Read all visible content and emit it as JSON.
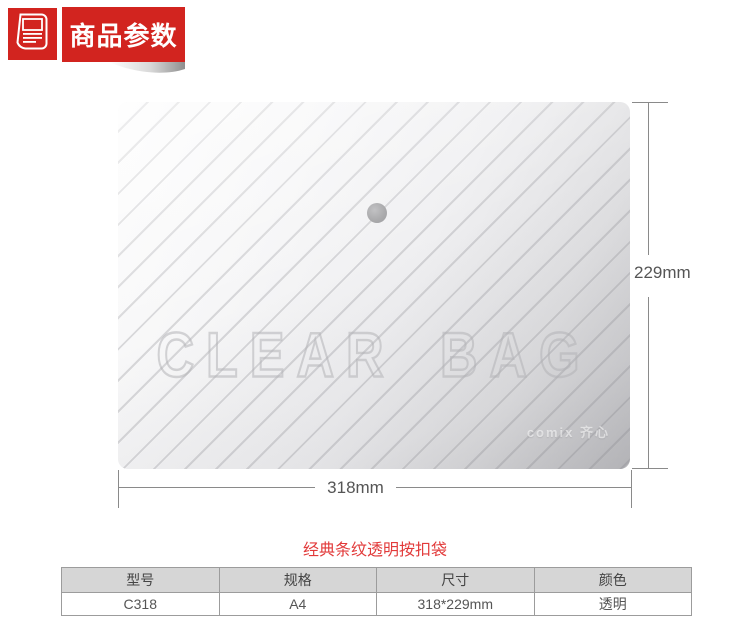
{
  "header": {
    "badge_label": "商品参数",
    "icon": "document-icon"
  },
  "product_image": {
    "watermark": "CLEAR BAG",
    "brand_mark": "comix 齐心",
    "snap_button": "snap-fastener",
    "height_dimension": "229mm",
    "width_dimension": "318mm"
  },
  "caption": "经典条纹透明按扣袋",
  "spec_table": {
    "headers": [
      "型号",
      "规格",
      "尺寸",
      "颜色"
    ],
    "rows": [
      [
        "C318",
        "A4",
        "318*229mm",
        "透明"
      ]
    ]
  },
  "colors": {
    "accent_red": "#d2241f",
    "caption_red": "#e23a3a",
    "dimension_line_gray": "#8a8a8a",
    "table_header_bg": "#d6d6d6",
    "snap_gray": "#ababad"
  }
}
